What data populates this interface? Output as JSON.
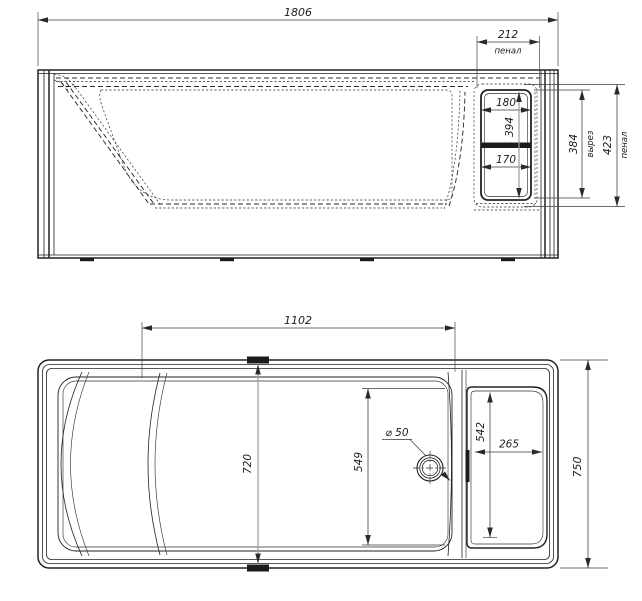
{
  "side_view": {
    "dimensions": {
      "overall_length": "1806",
      "shelf_width": "212",
      "shelf_width_note": "пенал",
      "upper_cutout_width": "180",
      "cutout_inner_height": "394",
      "lower_cutout_width": "170",
      "cutout_height": "384",
      "cutout_note": "вырез",
      "shelf_height": "423",
      "shelf_height_note": "пенал"
    }
  },
  "plan_view": {
    "dimensions": {
      "basin_length": "1102",
      "basin_width": "720",
      "floor_length": "549",
      "drain_diameter": "⌀ 50",
      "shelf_opening_height": "542",
      "shelf_depth": "265",
      "overall_width": "750"
    }
  },
  "colors": {
    "line": "#222222",
    "dimension_line": "#3a3a3a",
    "gray_dimension": "#9b9b9b",
    "background": "#ffffff"
  }
}
